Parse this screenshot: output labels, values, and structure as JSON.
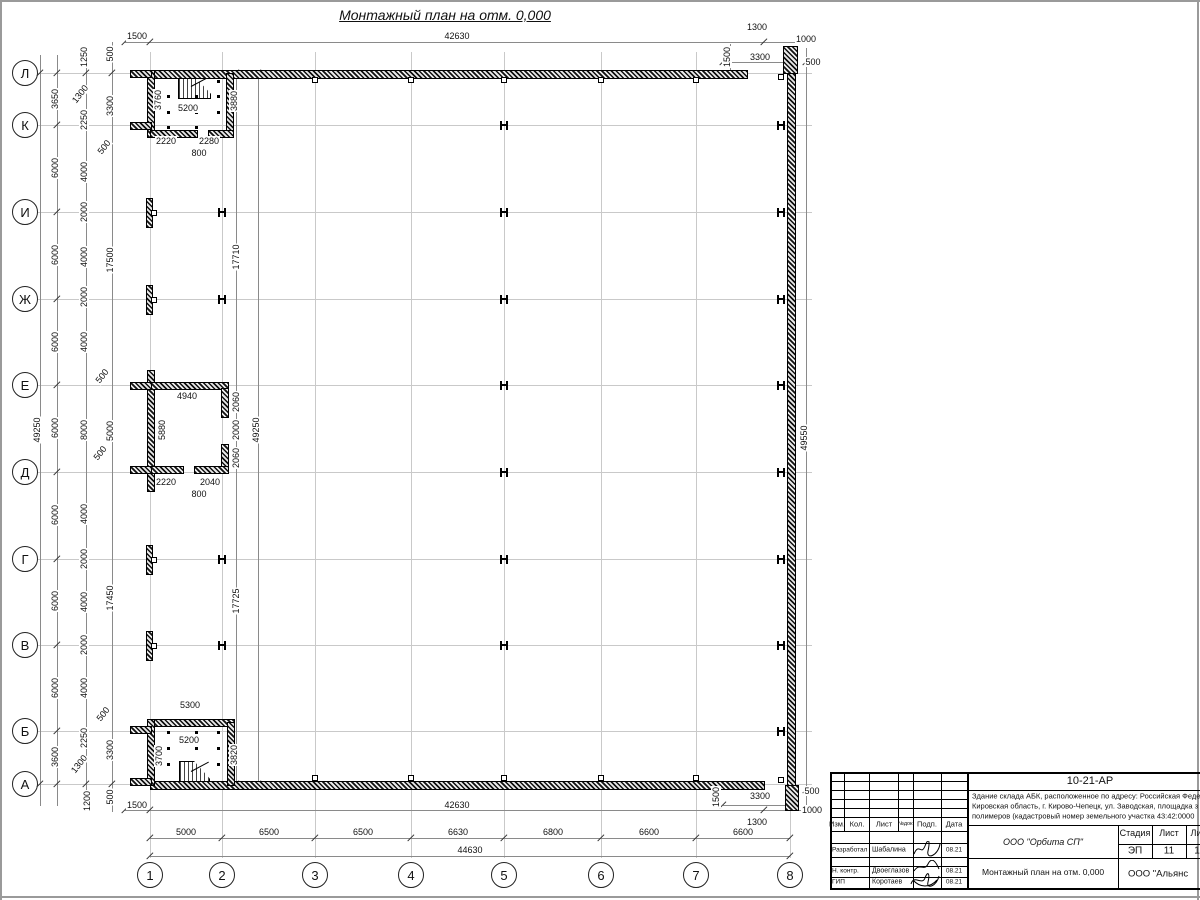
{
  "title": "Монтажный план на отм. 0,000",
  "colors": {
    "line": "#000000",
    "grid": "#c9c9c9",
    "dim": "#8a8a8a",
    "paper": "#ffffff"
  },
  "axes": {
    "rows": [
      {
        "label": "Л",
        "y": 73
      },
      {
        "label": "К",
        "y": 125
      },
      {
        "label": "И",
        "y": 212
      },
      {
        "label": "Ж",
        "y": 299
      },
      {
        "label": "Е",
        "y": 385
      },
      {
        "label": "Д",
        "y": 472
      },
      {
        "label": "Г",
        "y": 559
      },
      {
        "label": "В",
        "y": 645
      },
      {
        "label": "Б",
        "y": 731
      },
      {
        "label": "А",
        "y": 784
      }
    ],
    "cols": [
      {
        "label": "1",
        "x": 150
      },
      {
        "label": "2",
        "x": 222
      },
      {
        "label": "3",
        "x": 315
      },
      {
        "label": "4",
        "x": 411
      },
      {
        "label": "5",
        "x": 504
      },
      {
        "label": "6",
        "x": 601
      },
      {
        "label": "7",
        "x": 696
      },
      {
        "label": "8",
        "x": 790
      }
    ]
  },
  "plan": {
    "walls": [
      [
        150,
        70,
        596,
        7
      ],
      [
        787,
        48,
        7,
        742
      ],
      [
        150,
        781,
        613,
        7
      ],
      [
        783,
        46,
        13,
        26
      ],
      [
        785,
        785,
        12,
        24
      ],
      [
        147,
        70,
        6,
        66
      ],
      [
        226,
        73,
        6,
        63
      ],
      [
        150,
        130,
        46,
        6
      ],
      [
        208,
        130,
        24,
        6
      ],
      [
        130,
        70,
        20,
        6
      ],
      [
        130,
        122,
        20,
        6
      ],
      [
        147,
        370,
        6,
        120
      ],
      [
        150,
        382,
        77,
        6
      ],
      [
        221,
        388,
        6,
        28
      ],
      [
        221,
        444,
        6,
        28
      ],
      [
        150,
        466,
        32,
        6
      ],
      [
        194,
        466,
        33,
        6
      ],
      [
        130,
        382,
        20,
        6
      ],
      [
        130,
        466,
        20,
        6
      ],
      [
        150,
        719,
        83,
        6
      ],
      [
        147,
        719,
        6,
        65
      ],
      [
        227,
        722,
        6,
        62
      ],
      [
        130,
        726,
        20,
        6
      ],
      [
        130,
        778,
        20,
        6
      ],
      [
        146,
        198,
        5,
        28
      ],
      [
        146,
        285,
        5,
        28
      ],
      [
        146,
        545,
        5,
        28
      ],
      [
        146,
        631,
        5,
        28
      ]
    ],
    "wall_ticks": [
      [
        312,
        77
      ],
      [
        408,
        77
      ],
      [
        501,
        77
      ],
      [
        598,
        77
      ],
      [
        693,
        77
      ],
      [
        312,
        775
      ],
      [
        408,
        775
      ],
      [
        501,
        775
      ],
      [
        598,
        775
      ],
      [
        693,
        775
      ],
      [
        778,
        74
      ],
      [
        778,
        777
      ],
      [
        151,
        210
      ],
      [
        151,
        297
      ],
      [
        151,
        557
      ],
      [
        151,
        643
      ]
    ],
    "dots": [
      [
        167,
        95
      ],
      [
        167,
        111
      ],
      [
        167,
        126
      ],
      [
        195,
        95
      ],
      [
        195,
        111
      ],
      [
        195,
        126
      ],
      [
        217,
        80
      ],
      [
        217,
        95
      ],
      [
        217,
        111
      ],
      [
        167,
        731
      ],
      [
        167,
        747
      ],
      [
        167,
        763
      ],
      [
        195,
        731
      ],
      [
        195,
        747
      ],
      [
        217,
        731
      ],
      [
        217,
        747
      ],
      [
        217,
        763
      ]
    ],
    "steel_columns": [
      [
        504,
        125
      ],
      [
        504,
        212
      ],
      [
        504,
        299
      ],
      [
        504,
        385
      ],
      [
        504,
        472
      ],
      [
        504,
        559
      ],
      [
        504,
        645
      ],
      [
        222,
        212
      ],
      [
        222,
        299
      ],
      [
        222,
        559
      ],
      [
        222,
        645
      ],
      [
        781,
        125
      ],
      [
        781,
        212
      ],
      [
        781,
        299
      ],
      [
        781,
        385
      ],
      [
        781,
        472
      ],
      [
        781,
        559
      ],
      [
        781,
        645
      ],
      [
        781,
        731
      ]
    ],
    "dim_lines": [
      [
        40,
        55,
        40,
        806
      ],
      [
        57,
        55,
        57,
        806
      ],
      [
        86,
        46,
        86,
        812
      ],
      [
        112,
        42,
        112,
        812
      ],
      [
        236,
        73,
        236,
        784
      ],
      [
        258,
        73,
        258,
        784
      ],
      [
        806,
        48,
        806,
        810
      ],
      [
        730,
        44,
        730,
        72
      ],
      [
        718,
        785,
        718,
        808
      ],
      [
        125,
        42,
        816,
        42
      ],
      [
        125,
        810,
        822,
        810
      ],
      [
        150,
        838,
        790,
        838
      ],
      [
        150,
        856,
        790,
        856
      ],
      [
        723,
        62,
        790,
        62
      ],
      [
        723,
        805,
        790,
        805
      ]
    ],
    "ticks_extra": [
      [
        150,
        42
      ],
      [
        764,
        42
      ],
      [
        125,
        42
      ],
      [
        150,
        810
      ],
      [
        764,
        810
      ],
      [
        125,
        810
      ],
      [
        150,
        856
      ],
      [
        790,
        856
      ],
      [
        40,
        73
      ],
      [
        40,
        784
      ],
      [
        236,
        73
      ],
      [
        236,
        784
      ],
      [
        258,
        73
      ],
      [
        258,
        784
      ],
      [
        86,
        73
      ],
      [
        86,
        784
      ],
      [
        112,
        73
      ],
      [
        112,
        784
      ],
      [
        806,
        62
      ],
      [
        806,
        790
      ],
      [
        723,
        62
      ],
      [
        790,
        62
      ],
      [
        723,
        805
      ],
      [
        790,
        805
      ]
    ]
  },
  "labels": {
    "h": [
      [
        "1500",
        137,
        36
      ],
      [
        "42630",
        457,
        36
      ],
      [
        "1300",
        757,
        27
      ],
      [
        "1000",
        806,
        39
      ],
      [
        "3300",
        760,
        57
      ],
      [
        "500",
        813,
        62
      ],
      [
        "1500",
        137,
        805
      ],
      [
        "42630",
        457,
        805
      ],
      [
        "3300",
        760,
        796
      ],
      [
        "500",
        812,
        791
      ],
      [
        "1000",
        812,
        810
      ],
      [
        "1300",
        757,
        822
      ],
      [
        "5000",
        186,
        832
      ],
      [
        "6500",
        269,
        832
      ],
      [
        "6500",
        363,
        832
      ],
      [
        "6630",
        458,
        832
      ],
      [
        "6800",
        553,
        832
      ],
      [
        "6600",
        649,
        832
      ],
      [
        "6600",
        743,
        832
      ],
      [
        "44630",
        470,
        850
      ],
      [
        "5200",
        188,
        108
      ],
      [
        "2220",
        166,
        141
      ],
      [
        "2280",
        209,
        141
      ],
      [
        "800",
        199,
        153
      ],
      [
        "4940",
        187,
        396
      ],
      [
        "2220",
        166,
        482
      ],
      [
        "2040",
        210,
        482
      ],
      [
        "800",
        199,
        494
      ],
      [
        "5300",
        190,
        705
      ],
      [
        "5200",
        189,
        740
      ]
    ],
    "v": [
      [
        "49250",
        37,
        430
      ],
      [
        "3650",
        55,
        99
      ],
      [
        "6000",
        55,
        168
      ],
      [
        "6000",
        55,
        255
      ],
      [
        "6000",
        55,
        342
      ],
      [
        "6000",
        55,
        428
      ],
      [
        "6000",
        55,
        515
      ],
      [
        "6000",
        55,
        601
      ],
      [
        "6000",
        55,
        688
      ],
      [
        "3600",
        55,
        757
      ],
      [
        "1250",
        84,
        57
      ],
      [
        "2250",
        84,
        120
      ],
      [
        "4000",
        84,
        172
      ],
      [
        "2000",
        84,
        212
      ],
      [
        "4000",
        84,
        257
      ],
      [
        "2000",
        84,
        297
      ],
      [
        "4000",
        84,
        342
      ],
      [
        "8000",
        84,
        430
      ],
      [
        "4000",
        84,
        514
      ],
      [
        "2000",
        84,
        559
      ],
      [
        "4000",
        84,
        602
      ],
      [
        "2000",
        84,
        645
      ],
      [
        "4000",
        84,
        688
      ],
      [
        "2250",
        84,
        738
      ],
      [
        "1200",
        87,
        801
      ],
      [
        "500",
        110,
        54
      ],
      [
        "3300",
        110,
        106
      ],
      [
        "17500",
        110,
        260
      ],
      [
        "5000",
        110,
        431
      ],
      [
        "17450",
        110,
        598
      ],
      [
        "3300",
        110,
        750
      ],
      [
        "500",
        110,
        797
      ],
      [
        "3880",
        234,
        101
      ],
      [
        "17710",
        236,
        257
      ],
      [
        "2060",
        236,
        402
      ],
      [
        "2000",
        236,
        430
      ],
      [
        "2060",
        236,
        458
      ],
      [
        "17725",
        236,
        601
      ],
      [
        "3820",
        234,
        755
      ],
      [
        "49250",
        256,
        430
      ],
      [
        "49550",
        804,
        438
      ],
      [
        "1500",
        727,
        57
      ],
      [
        "1500",
        716,
        797
      ],
      [
        "3760",
        158,
        100
      ],
      [
        "5880",
        162,
        430
      ],
      [
        "3700",
        159,
        756
      ]
    ],
    "d": [
      [
        "1300",
        80,
        94
      ],
      [
        "500",
        104,
        147
      ],
      [
        "500",
        102,
        376
      ],
      [
        "500",
        100,
        453
      ],
      [
        "500",
        103,
        714
      ],
      [
        "1300",
        79,
        764
      ]
    ]
  },
  "title_block": {
    "doc_number": "10-21-АР",
    "description_line1": "Здание склада АБК, расположенное по адресу: Российская Феде",
    "description_line2": "Кировская область, г. Кирово-Чепецк, ул. Заводская, площадка з",
    "description_line3": "полимеров (кадастровый номер земельного участка 43:42:0000",
    "org1": "ООО \"Орбита СП\"",
    "sheet_title": "Монтажный план на отм. 0,000",
    "org2": "ООО \"Альянс",
    "stage_label": "Стадия",
    "sheet_label": "Лист",
    "sheets_label": "Ли",
    "stage_value": "ЭП",
    "sheet_value": "11",
    "sheets_value": "1",
    "col_izm": "Изм.",
    "col_kol": "Кол.",
    "col_list": "Лист",
    "col_ndok": "№док.",
    "col_podp": "Подп.",
    "col_data": "Дата",
    "role1": "Разработал",
    "name1": "Шабалина",
    "date1": "08.21",
    "role2": "Н. контр.",
    "name2": "Двоеглазов",
    "date2": "08.21",
    "role3": "ГИП",
    "name3": "Коротаев",
    "date3": "08.21"
  }
}
